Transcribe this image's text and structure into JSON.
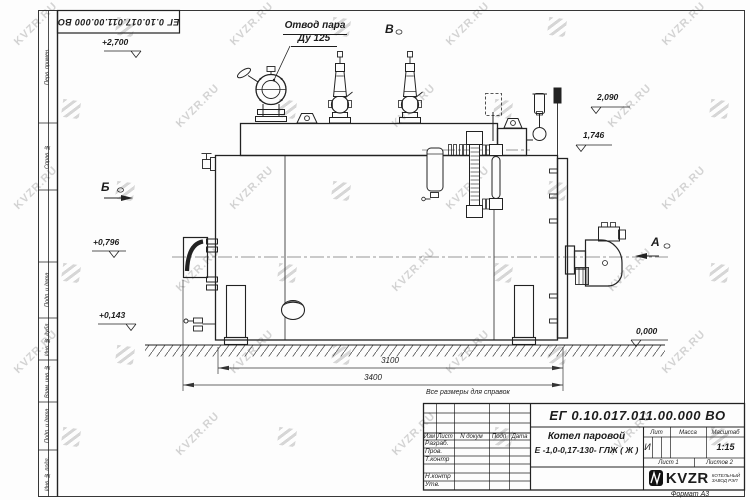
{
  "watermark": {
    "text": "KVZR.RU"
  },
  "frame": {
    "stamp_number": "ЕГ 0.10.017.011.00.000 ВО",
    "margin_labels": [
      "Перв. примен.",
      "Справ. №",
      "Подп. и дата",
      "Инв. № дубл.",
      "Взам. инв. №",
      "Подп. и дата",
      "Инв. № подл."
    ],
    "format_label": "Формат А3"
  },
  "drawing": {
    "callout": {
      "line1": "Отвод пара",
      "line2": "Ду 125"
    },
    "views": {
      "b": "Б",
      "v": "В",
      "a": "А"
    },
    "elevations": {
      "top": "+2,700",
      "h2090": "2,090",
      "h1746": "1,746",
      "h0796": "+0,796",
      "h0143": "+0,143",
      "zero": "0,000"
    },
    "dimensions": {
      "inner": "3100",
      "outer": "3400"
    }
  },
  "title_block": {
    "reference_note": "Все размеры для справок",
    "doc_number": "ЕГ 0.10.017.011.00.000  ВО",
    "name_line1": "Котел паровой",
    "name_line2": "Е -1,0-0,17-130- ГЛЖ ( Ж )",
    "col_headers": {
      "izm": "Изм",
      "list": "Лист",
      "doc": "N докум",
      "podp": "Подп",
      "data": "Дата"
    },
    "roles": {
      "r1": "Разраб.",
      "r2": "Пров.",
      "r3": "Т.контр",
      "r4": "Н.контр",
      "r5": "Утв."
    },
    "lit_header": "Лит",
    "mass_header": "Масса",
    "scale_header": "Масштаб",
    "lit_value": "И",
    "scale_value": "1:15",
    "sheet_label": "Лист 1",
    "sheets_label": "Листов 2",
    "logo": {
      "brand": "KVZR",
      "sub1": "КОТЕЛЬНЫЙ",
      "sub2": "ЗАВОД РЭП"
    }
  }
}
